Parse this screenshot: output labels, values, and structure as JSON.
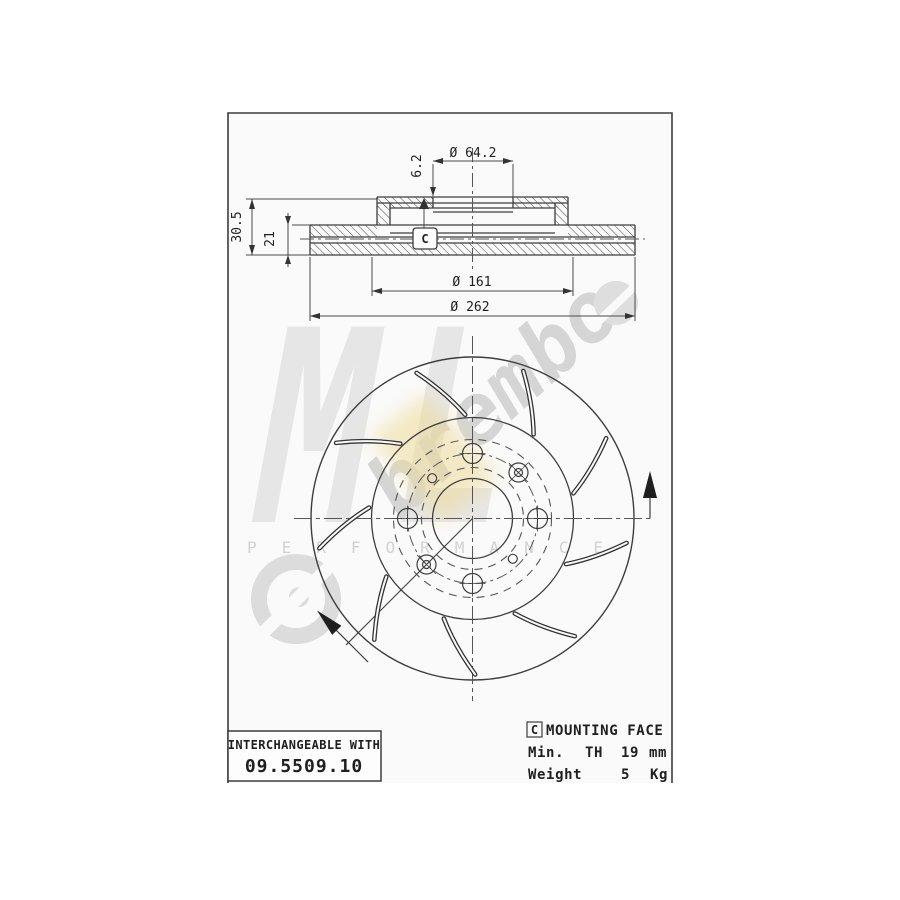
{
  "page": {
    "background": "#ffffff",
    "line_color": "#3d3d3d"
  },
  "drawing": {
    "section": {
      "hub_bore_dia": "Ø 64.2",
      "offset": "6.2",
      "total_height": "30.5",
      "inner_height": "21",
      "contact_dia": "Ø 161",
      "outer_dia": "Ø 262",
      "face_marker": "C"
    },
    "info": {
      "interchangeable": {
        "label": "INTERCHANGEABLE WITH",
        "part_number": "09.5509.10"
      },
      "mounting": {
        "marker": "C",
        "label": "MOUNTING FACE"
      },
      "min_thickness": {
        "w1": "Min.",
        "w2": "TH",
        "value": "19",
        "unit": "mm"
      },
      "weight": {
        "label": "Weight",
        "value": "5",
        "unit": "Kg"
      }
    },
    "watermark": {
      "brand": "ML",
      "tagline": "PERFORMANCE",
      "script": "brembo"
    }
  }
}
